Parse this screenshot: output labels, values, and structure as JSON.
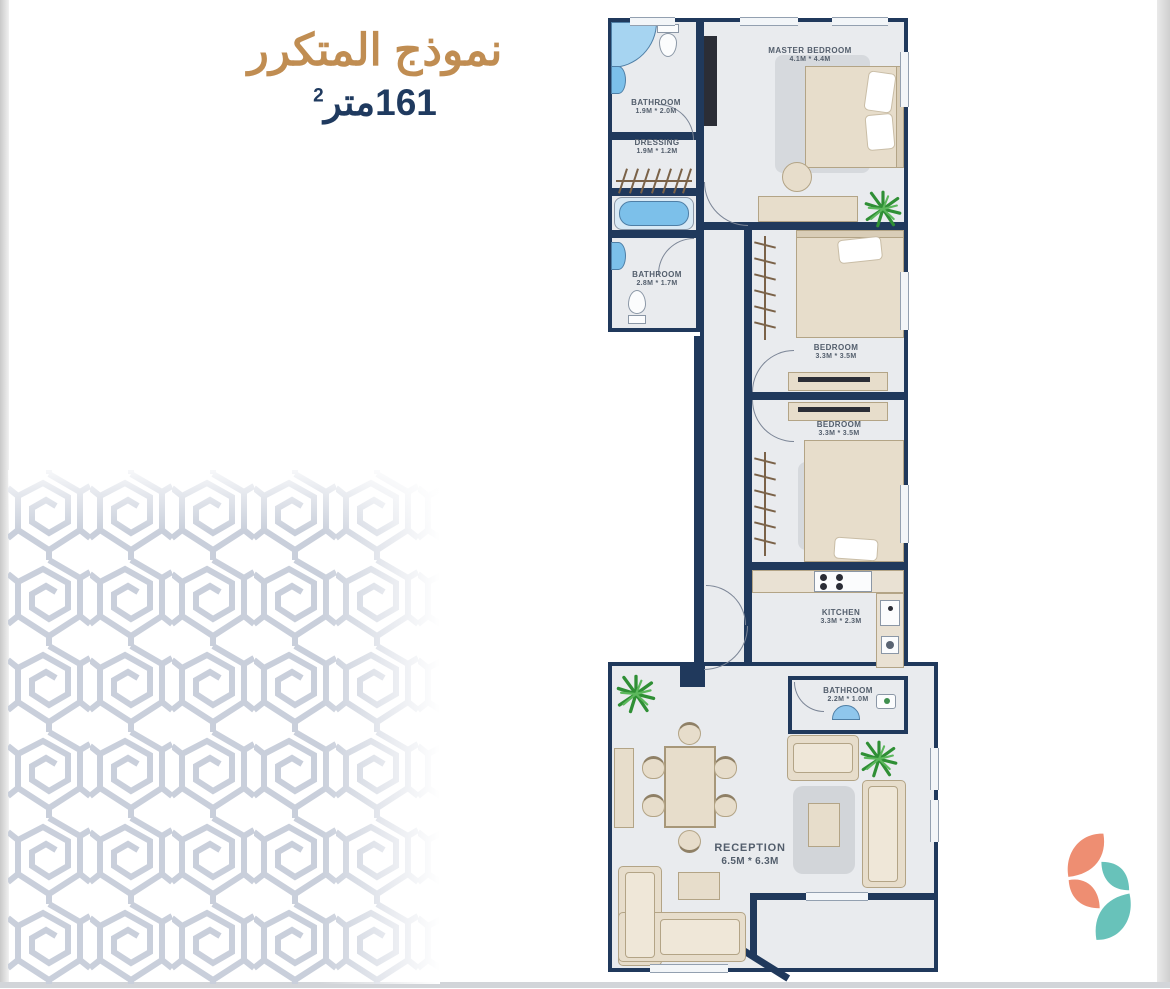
{
  "header": {
    "title_ar": "نموذج المتكرر",
    "area_value": "161",
    "area_unit": "متر",
    "area_sup": "2"
  },
  "plan": {
    "rooms": [
      {
        "id": "master-bedroom",
        "name": "MASTER BEDROOM",
        "dims": "4.1M * 4.4M"
      },
      {
        "id": "bathroom-top",
        "name": "BATHROOM",
        "dims": "1.9M * 2.0M"
      },
      {
        "id": "dressing",
        "name": "DRESSING",
        "dims": "1.9M * 1.2M"
      },
      {
        "id": "bathroom-mid",
        "name": "BATHROOM",
        "dims": "2.8M * 1.7M"
      },
      {
        "id": "bedroom-1",
        "name": "BEDROOM",
        "dims": "3.3M * 3.5M"
      },
      {
        "id": "bedroom-2",
        "name": "BEDROOM",
        "dims": "3.3M * 3.5M"
      },
      {
        "id": "kitchen",
        "name": "KITCHEN",
        "dims": "3.3M * 2.3M"
      },
      {
        "id": "bathroom-small",
        "name": "BATHROOM",
        "dims": "2.2M * 1.0M"
      },
      {
        "id": "reception",
        "name": "RECEPTION",
        "dims": "6.5M * 6.3M"
      }
    ]
  },
  "colors": {
    "accent_gold": "#c08d52",
    "navy_text": "#1f3a5f",
    "wall_navy": "#20395c",
    "floor_gray": "#e9ebee",
    "furniture_beige": "#e7ddcb",
    "fixture_blue": "#7cc0ea",
    "plant_green": "#3ba243",
    "pattern_gray": "#c9cfdb",
    "logo_coral": "#ee8e72",
    "logo_teal": "#68c2ba"
  }
}
